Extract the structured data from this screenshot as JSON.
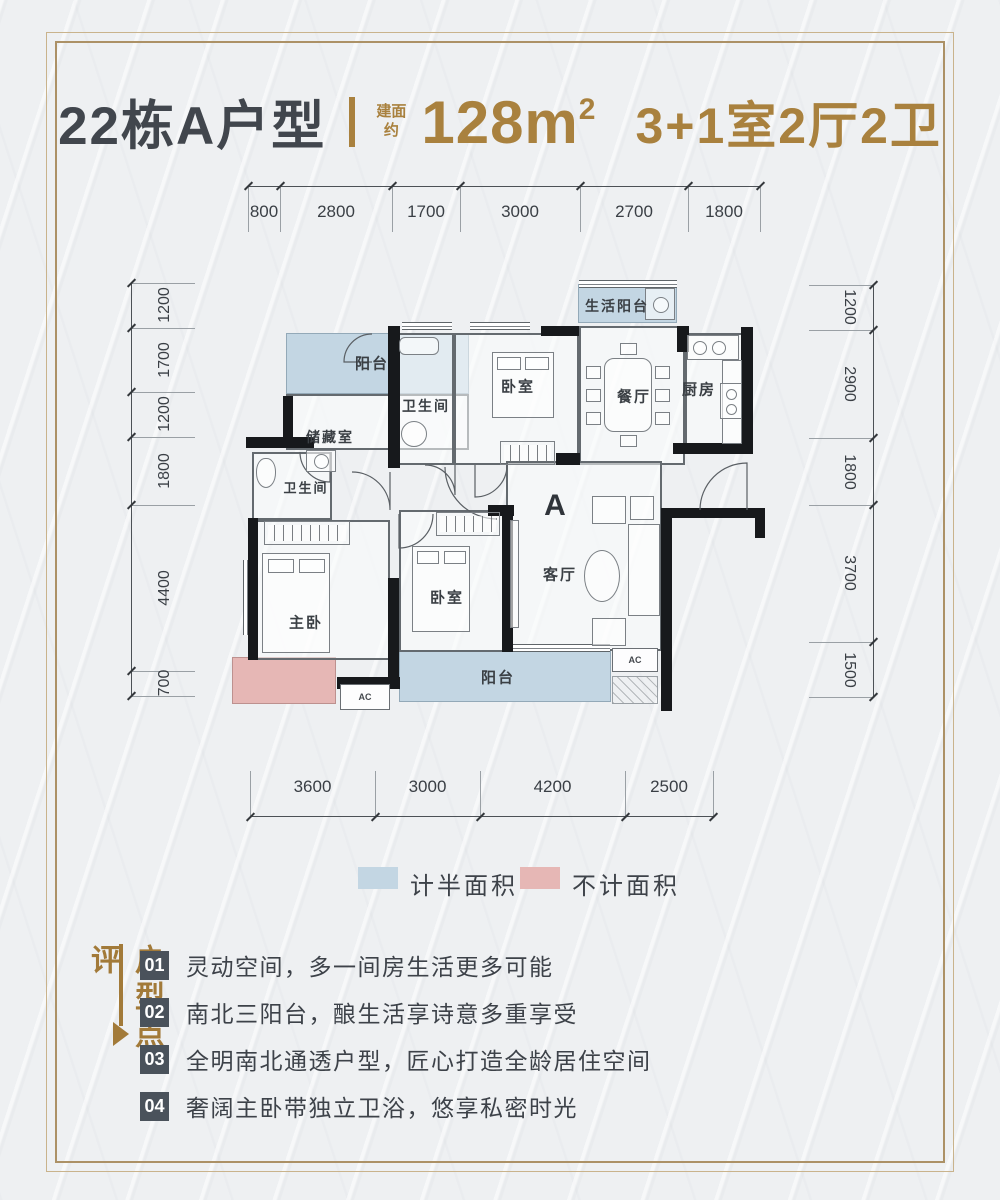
{
  "title": {
    "building": "22栋A户型",
    "area_prefix_top": "建面",
    "area_prefix_bottom": "约",
    "area_value": "128m",
    "area_sup": "2",
    "layout": "3+1室2厅2卫"
  },
  "colors": {
    "gold_accent": "#a9813e",
    "dark_text": "#41464d",
    "half_area_blue": "#c3d6e3",
    "no_area_pink": "#e6b7b5",
    "wall_black": "#17191c"
  },
  "dimensions": {
    "top": [
      "800",
      "2800",
      "1700",
      "3000",
      "2700",
      "1800"
    ],
    "bottom": [
      "3600",
      "3000",
      "4200",
      "2500"
    ],
    "left": [
      "1200",
      "1700",
      "1200",
      "1800",
      "4400",
      "700"
    ],
    "right": [
      "1200",
      "2900",
      "1800",
      "3700",
      "1500"
    ]
  },
  "rooms": {
    "balcony_top": "阳台",
    "storage": "储藏室",
    "bath_top": "卫生间",
    "bedroom_top": "卧室",
    "living_balcony": "生活阳台",
    "dining": "餐厅",
    "kitchen": "厨房",
    "bath_master": "卫生间",
    "master": "主卧",
    "bedroom_2": "卧室",
    "living": "客厅",
    "balcony_bottom": "阳台",
    "unit_marker": "A",
    "ac": "AC"
  },
  "legend": {
    "half_area": "计半面积",
    "no_area": "不计面积"
  },
  "review": {
    "section_title": "户型点评",
    "items": [
      {
        "num": "01",
        "text": "灵动空间，多一间房生活更多可能"
      },
      {
        "num": "02",
        "text": "南北三阳台，酿生活享诗意多重享受"
      },
      {
        "num": "03",
        "text": "全明南北通透户型，匠心打造全龄居住空间"
      },
      {
        "num": "04",
        "text": "奢阔主卧带独立卫浴，悠享私密时光"
      }
    ]
  }
}
